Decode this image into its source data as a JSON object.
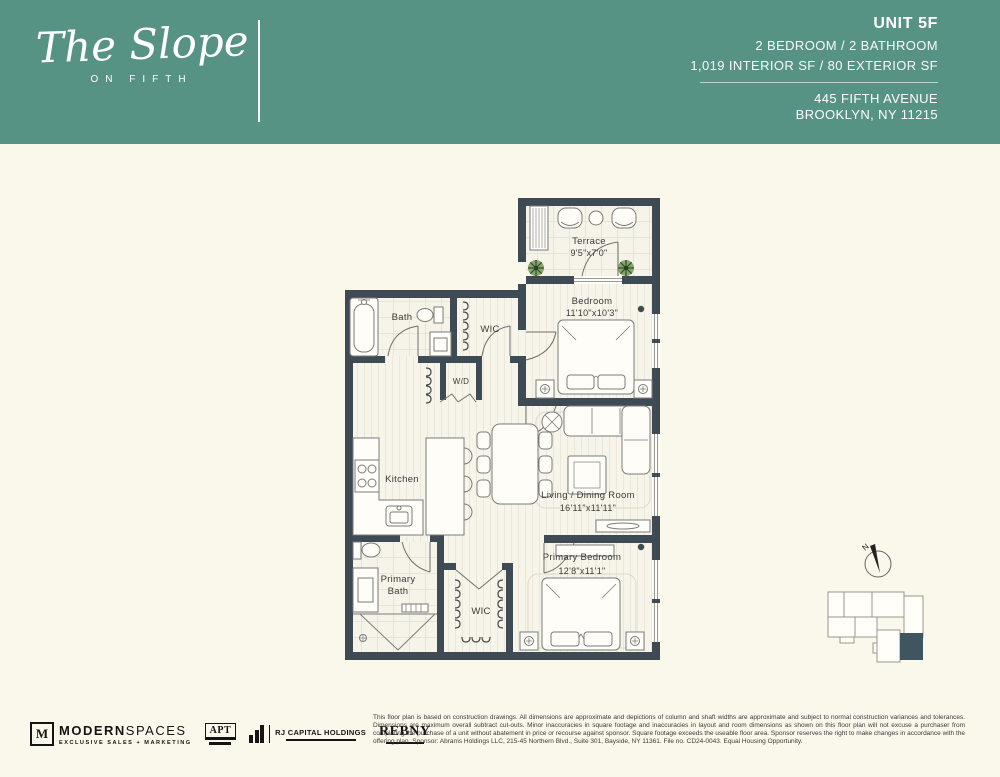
{
  "header": {
    "logo_script": "The Slope",
    "logo_sub": "ON FIFTH",
    "unit_label": "UNIT 5F",
    "spec_line1": "2 BEDROOM  /  2 BATHROOM",
    "spec_line2": "1,019 INTERIOR SF  /  80 EXTERIOR SF",
    "address_line1": "445 FIFTH AVENUE",
    "address_line2": "BROOKLYN, NY 11215",
    "bg_color": "#579384",
    "text_color": "#ffffff"
  },
  "floorplan": {
    "rooms": {
      "terrace": {
        "name": "Terrace",
        "dims": "9'5\"x7'0\""
      },
      "bedroom": {
        "name": "Bedroom",
        "dims": "11'10\"x10'3\""
      },
      "bath": {
        "name": "Bath"
      },
      "wic_upper": {
        "name": "WIC"
      },
      "wd": {
        "name": "W/D"
      },
      "kitchen": {
        "name": "Kitchen"
      },
      "living_dining": {
        "name": "Living / Dining Room",
        "dims": "16'11\"x11'11\""
      },
      "primary_bath": {
        "line1": "Primary",
        "line2": "Bath"
      },
      "wic_lower": {
        "name": "WIC"
      },
      "primary_bedroom": {
        "name": "Primary Bedroom",
        "dims": "12'8\"x11'1\""
      }
    },
    "compass_label": "N",
    "colors": {
      "wall": "#3e4a54",
      "floor": "#f7f4ea",
      "keyplan_highlight": "#3f5560"
    }
  },
  "footer": {
    "logos": {
      "modernspaces": {
        "mark": "M",
        "name_bold": "MODERN",
        "name_light": "SPACES",
        "tagline": "EXCLUSIVE SALES + MARKETING"
      },
      "apt": {
        "text": "APT"
      },
      "rj": {
        "text": "RJ CAPITAL HOLDINGS"
      },
      "rebny": {
        "text": "REBNY"
      }
    },
    "disclaimer": "This floor plan is based on construction drawings. All dimensions are approximate and depictions of column and shaft widths are approximate and subject to normal construction variances and tolerances. Dimensions are maximum overall subtract cut-outs. Minor inaccuracies in square footage and inaccuracies in layout and room dimensions as shown on this floor plan will not excuse a purchaser from completing the purchase of a unit without abatement in price or recourse against sponsor. Square footage exceeds the useable floor area. Sponsor reserves the right to make changes in accordance with the offering plan. Sponsor: Abrams Holdings LLC, 215-45 Northern Blvd., Suite 301, Bayside, NY 11361. File no. CD24-0043. Equal Housing Opportunity."
  }
}
